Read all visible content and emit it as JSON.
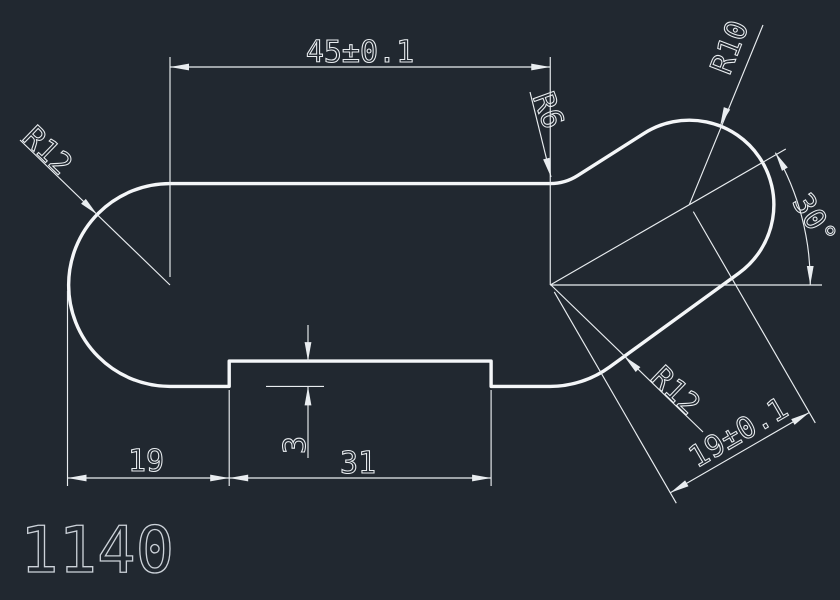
{
  "drawing": {
    "colors": {
      "background": "#212830",
      "outline": "#f4f6f8",
      "thin_line": "#e9edf0",
      "dim_text": "#e9edf0",
      "part_number_text": "#ccd2d9"
    },
    "part_number": "1140",
    "dimensions": {
      "overall_length": "45±0.1",
      "left_end_radius": "R12",
      "neck_fillet_radius": "R6",
      "head_radius": "R10",
      "head_angle": "30°",
      "right_fillet_radius": "R12",
      "center_distance": "19±0.1",
      "left_offset": "19",
      "recess_width": "31",
      "recess_depth": "3"
    }
  }
}
